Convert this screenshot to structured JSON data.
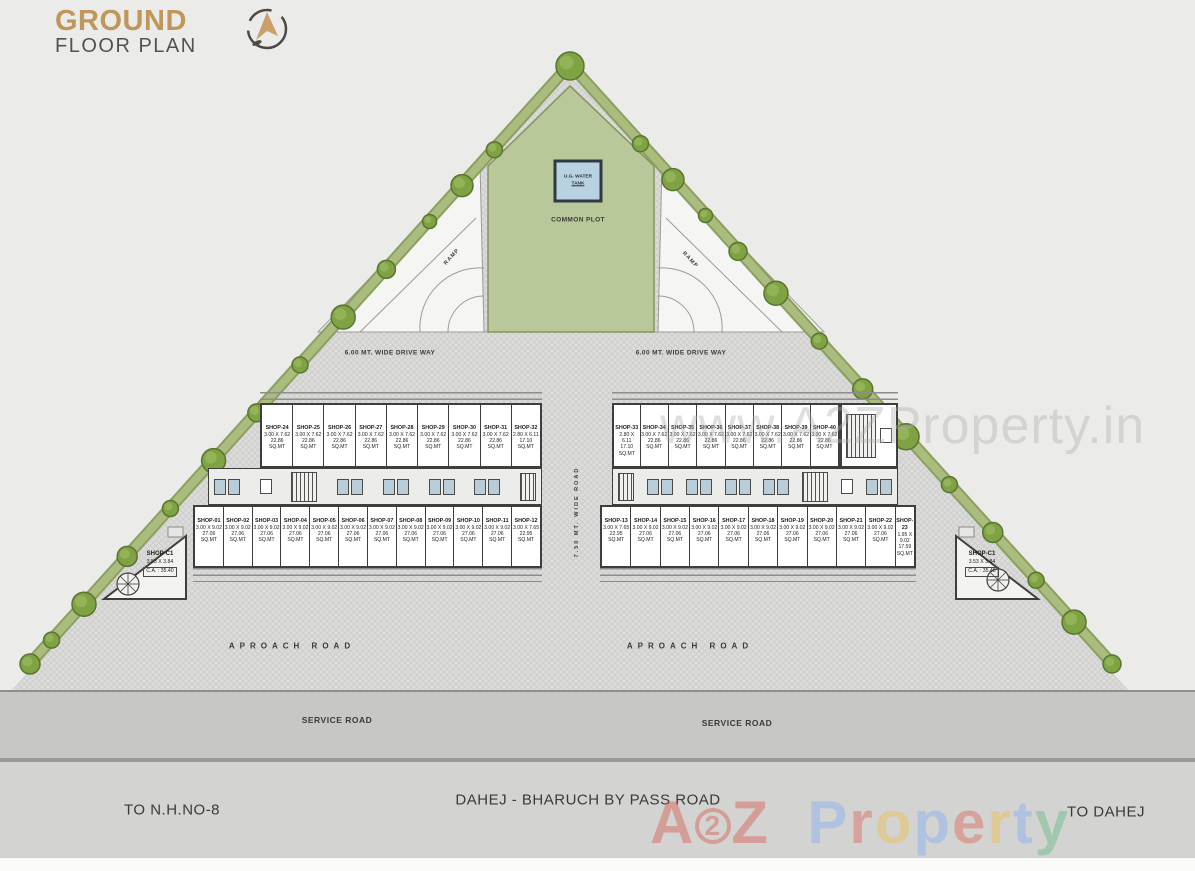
{
  "header": {
    "title_line1": "GROUND",
    "title_line2": "FLOOR PLAN"
  },
  "site": {
    "common_plot": "COMMON PLOT",
    "water_tank_line1": "U.G. WATER",
    "water_tank_line2": "TANK",
    "ramp_left": "RAMP",
    "ramp_right": "RAMP",
    "driveway_left": "6.00 MT. WIDE DRIVE WAY",
    "driveway_right": "6.00 MT. WIDE DRIVE WAY",
    "middle_road": "7.50 MT. WIDE ROAD",
    "approach_left": "APROACH ROAD",
    "approach_right": "APROACH ROAD",
    "service_left": "SERVICE ROAD",
    "service_right": "SERVICE ROAD",
    "to_nh": "TO N.H.NO-8",
    "bypass": "DAHEJ - BHARUCH BY PASS ROAD",
    "to_dahej": "TO DAHEJ"
  },
  "blocks": {
    "left": {
      "top_row": [
        {
          "name": "SHOP-24",
          "dim": "3.00 X 7.62",
          "area": "22.86",
          "unit": "SQ.MT"
        },
        {
          "name": "SHOP-25",
          "dim": "3.00 X 7.62",
          "area": "22.86",
          "unit": "SQ.MT"
        },
        {
          "name": "SHOP-26",
          "dim": "3.00 X 7.62",
          "area": "22.86",
          "unit": "SQ.MT"
        },
        {
          "name": "SHOP-27",
          "dim": "3.00 X 7.62",
          "area": "22.86",
          "unit": "SQ.MT"
        },
        {
          "name": "SHOP-28",
          "dim": "3.00 X 7.62",
          "area": "22.86",
          "unit": "SQ.MT"
        },
        {
          "name": "SHOP-29",
          "dim": "3.00 X 7.62",
          "area": "22.86",
          "unit": "SQ.MT"
        },
        {
          "name": "SHOP-30",
          "dim": "3.00 X 7.62",
          "area": "22.86",
          "unit": "SQ.MT"
        },
        {
          "name": "SHOP-31",
          "dim": "3.00 X 7.62",
          "area": "22.86",
          "unit": "SQ.MT"
        },
        {
          "name": "SHOP-32",
          "dim": "2.80 X 6.11",
          "area": "17.10",
          "unit": "SQ.MT"
        }
      ],
      "bottom_row": [
        {
          "name": "SHOP-01",
          "dim": "3.00 X 9.02",
          "area": "27.06",
          "unit": "SQ.MT"
        },
        {
          "name": "SHOP-02",
          "dim": "3.00 X 9.02",
          "area": "27.06",
          "unit": "SQ.MT"
        },
        {
          "name": "SHOP-03",
          "dim": "3.00 X 9.02",
          "area": "27.06",
          "unit": "SQ.MT"
        },
        {
          "name": "SHOP-04",
          "dim": "3.00 X 9.02",
          "area": "27.06",
          "unit": "SQ.MT"
        },
        {
          "name": "SHOP-05",
          "dim": "3.00 X 9.02",
          "area": "27.06",
          "unit": "SQ.MT"
        },
        {
          "name": "SHOP-06",
          "dim": "3.00 X 9.02",
          "area": "27.06",
          "unit": "SQ.MT"
        },
        {
          "name": "SHOP-07",
          "dim": "3.00 X 9.02",
          "area": "27.06",
          "unit": "SQ.MT"
        },
        {
          "name": "SHOP-08",
          "dim": "3.00 X 9.02",
          "area": "27.06",
          "unit": "SQ.MT"
        },
        {
          "name": "SHOP-09",
          "dim": "3.00 X 9.02",
          "area": "27.06",
          "unit": "SQ.MT"
        },
        {
          "name": "SHOP-10",
          "dim": "3.00 X 9.02",
          "area": "27.06",
          "unit": "SQ.MT"
        },
        {
          "name": "SHOP-11",
          "dim": "3.00 X 9.02",
          "area": "27.06",
          "unit": "SQ.MT"
        },
        {
          "name": "SHOP-12",
          "dim": "3.00 X 7.65",
          "area": "22.95",
          "unit": "SQ.MT"
        }
      ]
    },
    "right": {
      "top_row": [
        {
          "name": "SHOP-33",
          "dim": "2.80 X 6.11",
          "area": "17.10",
          "unit": "SQ.MT"
        },
        {
          "name": "SHOP-34",
          "dim": "3.00 X 7.62",
          "area": "22.86",
          "unit": "SQ.MT"
        },
        {
          "name": "SHOP-35",
          "dim": "3.00 X 7.62",
          "area": "22.86",
          "unit": "SQ.MT"
        },
        {
          "name": "SHOP-36",
          "dim": "3.00 X 7.62",
          "area": "22.86",
          "unit": "SQ.MT"
        },
        {
          "name": "SHOP-37",
          "dim": "3.00 X 7.62",
          "area": "22.86",
          "unit": "SQ.MT"
        },
        {
          "name": "SHOP-38",
          "dim": "3.00 X 7.62",
          "area": "22.86",
          "unit": "SQ.MT"
        },
        {
          "name": "SHOP-39",
          "dim": "3.00 X 7.62",
          "area": "22.86",
          "unit": "SQ.MT"
        },
        {
          "name": "SHOP-40",
          "dim": "3.00 X 7.62",
          "area": "22.86",
          "unit": "SQ.MT"
        }
      ],
      "bottom_row": [
        {
          "name": "SHOP-13",
          "dim": "3.00 X 7.65",
          "area": "22.95",
          "unit": "SQ.MT"
        },
        {
          "name": "SHOP-14",
          "dim": "3.00 X 9.02",
          "area": "27.06",
          "unit": "SQ.MT"
        },
        {
          "name": "SHOP-15",
          "dim": "3.00 X 9.02",
          "area": "27.06",
          "unit": "SQ.MT"
        },
        {
          "name": "SHOP-16",
          "dim": "3.00 X 9.02",
          "area": "27.06",
          "unit": "SQ.MT"
        },
        {
          "name": "SHOP-17",
          "dim": "3.00 X 9.02",
          "area": "27.06",
          "unit": "SQ.MT"
        },
        {
          "name": "SHOP-18",
          "dim": "3.00 X 9.02",
          "area": "27.06",
          "unit": "SQ.MT"
        },
        {
          "name": "SHOP-19",
          "dim": "3.00 X 9.02",
          "area": "27.06",
          "unit": "SQ.MT"
        },
        {
          "name": "SHOP-20",
          "dim": "3.00 X 9.02",
          "area": "27.06",
          "unit": "SQ.MT"
        },
        {
          "name": "SHOP-21",
          "dim": "3.00 X 9.02",
          "area": "27.06",
          "unit": "SQ.MT"
        },
        {
          "name": "SHOP-22",
          "dim": "3.00 X 9.02",
          "area": "27.06",
          "unit": "SQ.MT"
        },
        {
          "name": "SHOP-23",
          "dim": "1.95 X 9.02",
          "area": "17.59",
          "unit": "SQ.MT"
        }
      ]
    }
  },
  "corner_shops": {
    "left": {
      "name": "SHOP-C1",
      "dim": "3.53 X 3.84",
      "area": "C.A. : 35.40"
    },
    "right": {
      "name": "SHOP-C1",
      "dim": "3.53 X 3.84",
      "area": "C.A. : 35.40"
    }
  },
  "watermark": {
    "faint": "www.A2ZProperty.in",
    "brand_letters": [
      {
        "ch": "A",
        "c": "#d94f43"
      },
      {
        "ch": "2",
        "c": "#d94f43",
        "circle": true
      },
      {
        "ch": "Z",
        "c": "#d94f43"
      },
      {
        "ch": " ",
        "c": ""
      },
      {
        "ch": "P",
        "c": "#7baaf7"
      },
      {
        "ch": "r",
        "c": "#e05b4e"
      },
      {
        "ch": "o",
        "c": "#f2bf42"
      },
      {
        "ch": "p",
        "c": "#7baaf7"
      },
      {
        "ch": "e",
        "c": "#e05b4e"
      },
      {
        "ch": "r",
        "c": "#f2bf42"
      },
      {
        "ch": "t",
        "c": "#7baaf7"
      },
      {
        "ch": "y",
        "c": "#59b87c"
      }
    ]
  },
  "colors": {
    "title_gold": "#bf975a",
    "plot_green": "#b8c89b",
    "tank_blue": "#b9d2e2",
    "toilet_blue": "#b9cdd8"
  }
}
